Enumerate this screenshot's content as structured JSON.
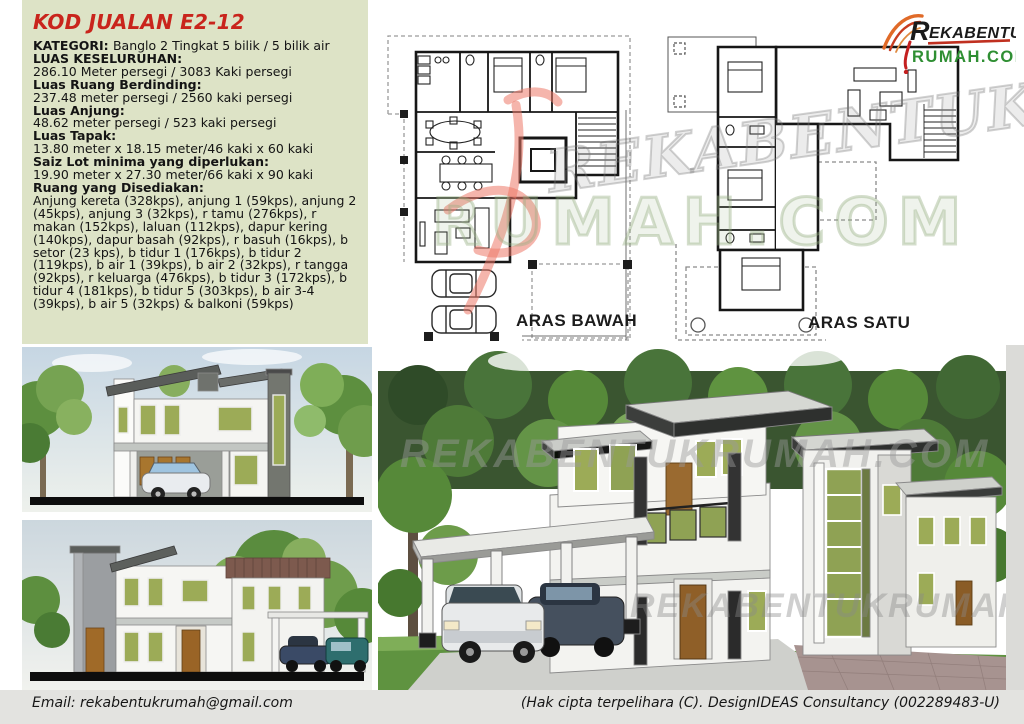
{
  "title_code": "KOD JUALAN E2-12",
  "specs": [
    {
      "label": "KATEGORI: ",
      "value": "Banglo 2 Tingkat 5 bilik / 5 bilik air"
    },
    {
      "label": "LUAS KESELURUHAN:",
      "value": "286.10 Meter persegi / 3083 Kaki persegi"
    },
    {
      "label": "Luas Ruang Berdinding:",
      "value": "237.48 meter persegi / 2560 kaki persegi"
    },
    {
      "label": "Luas Anjung:",
      "value": "48.62 meter persegi / 523 kaki persegi"
    },
    {
      "label": "Luas Tapak:",
      "value": "13.80 meter x 18.15 meter/46 kaki x 60 kaki"
    },
    {
      "label": "Saiz Lot minima yang diperlukan:",
      "value": "19.90 meter x 27.30 meter/66 kaki x 90 kaki"
    },
    {
      "label": "Ruang yang Disediakan:",
      "value": "Anjung kereta (328kps), anjung 1 (59kps), anjung 2 (45kps), anjung 3 (32kps), r tamu (276kps), r makan (152kps), laluan (112kps), dapur kering (140kps), dapur basah (92kps), r basuh (16kps), b setor (23 kps), b tidur 1 (176kps), b tidur 2 (119kps), b air 1 (39kps), b air 2 (32kps), r tangga (92kps), r keluarga (476kps), b tidur 3 (172kps), b tidur 4 (181kps), b tidur 5 (303kps), b air 3-4 (39kps), b air 5 (32kps) & balkoni (59kps)"
    }
  ],
  "plans": {
    "ground_label": "ARAS BAWAH",
    "first_label": "ARAS SATU"
  },
  "logo": {
    "line1": "Rekabentuk",
    "line2": "RUMAH.COM"
  },
  "watermark": {
    "text1": "REKABENTUK",
    "text2": "RUMAH.COM",
    "render_text": "REKABENTUKRUMAH.COM"
  },
  "footer": {
    "email": "Email: rekabentukrumah@gmail.com",
    "copyright": "(Hak cipta terpelihara (C). DesignIDEAS Consultancy (002289483-U)"
  },
  "colors": {
    "panel_green": "#dde3c6",
    "accent_red": "#c9241c",
    "logo_green": "#2f8f33",
    "window_olive": "#9cab57",
    "roof_gray": "#5a5d5a"
  }
}
